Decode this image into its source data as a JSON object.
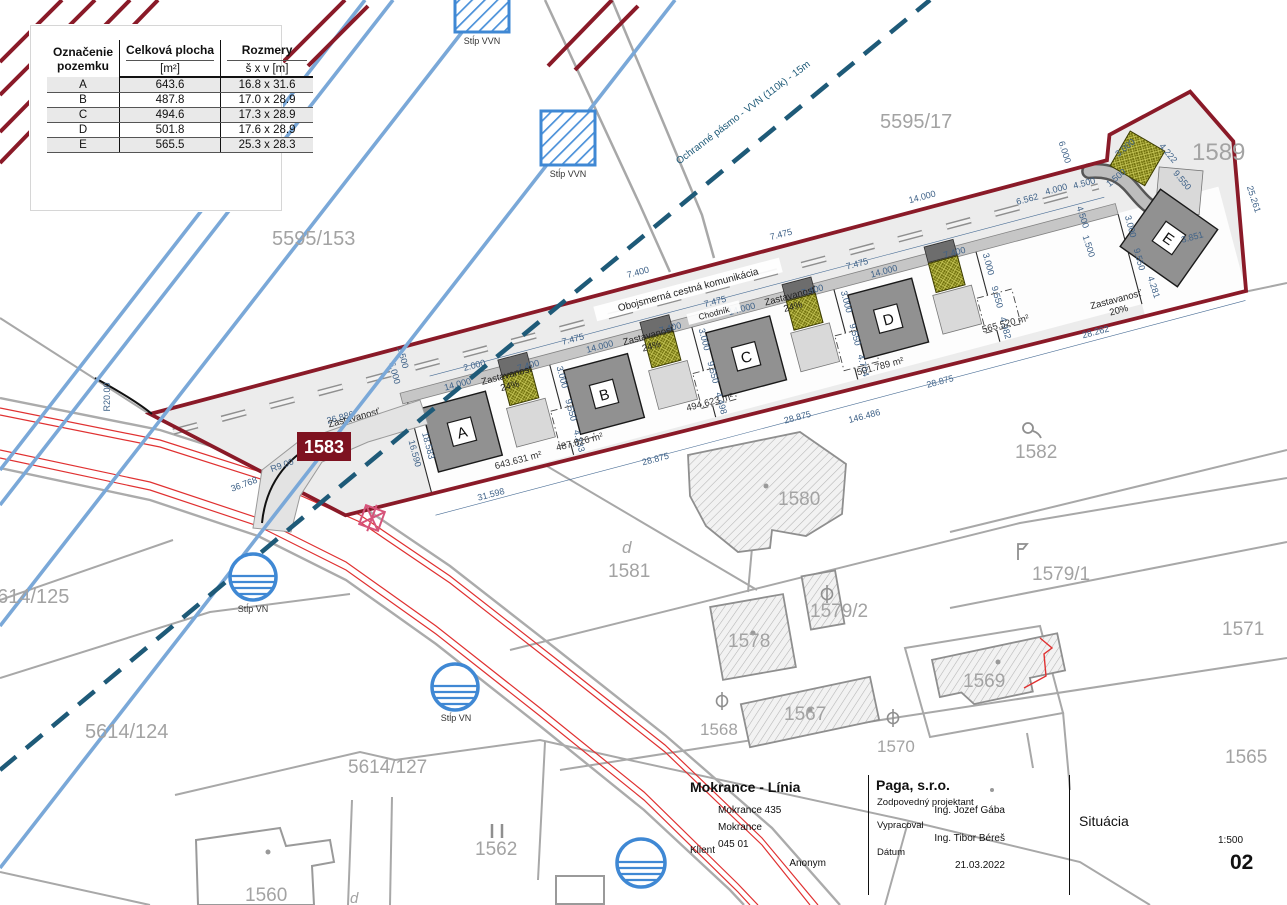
{
  "legend": {
    "col1_line1": "Označenie",
    "col1_line2": "pozemku",
    "col2_header": "Celková plocha",
    "col2_unit": "[m²]",
    "col3_header": "Rozmery",
    "col3_unit": "š x v [m]",
    "rows": [
      {
        "id": "A",
        "area": "643.6",
        "dim": "16.8 x 31.6"
      },
      {
        "id": "B",
        "area": "487.8",
        "dim": "17.0 x 28.9"
      },
      {
        "id": "C",
        "area": "494.6",
        "dim": "17.3 x 28.9"
      },
      {
        "id": "D",
        "area": "501.8",
        "dim": "17.6 x 28.9"
      },
      {
        "id": "E",
        "area": "565.5",
        "dim": "25.3 x 28.3"
      }
    ]
  },
  "title_block": {
    "project_title": "Mokrance - Línia",
    "address1": "Mokrance 435",
    "address2": "Mokrance",
    "address3": "045 01",
    "client_label": "Klient",
    "client_value": "Anonym",
    "company": "Paga, s.r.o.",
    "responsible_label": "Zodpovedný projektant",
    "responsible_value": "Ing. Jozef Gába",
    "author_label": "Vypracoval",
    "author_value": "Ing. Tibor Béreš",
    "date_label": "Dátum",
    "date_value": "21.03.2022",
    "drawing_title": "Situácia",
    "scale": "1:500",
    "sheet_number": "02"
  },
  "labels": {
    "road": "Obojsmerná cestná komunikácia",
    "sidewalk": "Chodník",
    "protection_zone": "Ochranné pásmo - VVN (110k) - 15m",
    "pole_vvn": "Stĺp VVN",
    "pole_vn": "Stĺp VN",
    "site_parcel": "1583"
  },
  "houses": {
    "a": "A",
    "b": "B",
    "c": "C",
    "d": "D",
    "e": "E"
  },
  "coverage": {
    "label": "Zastavanosť",
    "a": "18%",
    "b": "24%",
    "c": "24%",
    "d": "24%",
    "e": "20%"
  },
  "areas": {
    "a": "643.631 m²",
    "b": "487.826 m²",
    "c": "494.623 m²",
    "d": "501.789 m²",
    "e": "565.520 m²"
  },
  "dims": [
    "26.886",
    "6.000",
    "14.000",
    "7.400",
    "2.000",
    "7.475",
    "1.500",
    "3.000",
    "9.550",
    "4.233",
    "4.498",
    "4.704",
    "4.982",
    "18.583",
    "16.590",
    "31.598",
    "28.875",
    "146.486",
    "28.262",
    "25.261",
    "3.851",
    "4.281",
    "4.222",
    "6.562",
    "4.000",
    "4.500",
    "36.768",
    "R9.00",
    "R20.00"
  ],
  "parcels": {
    "p5595_17": "5595/17",
    "p5595_153": "5595/153",
    "p1589": "1589",
    "p1582": "1582",
    "p1580": "1580",
    "p1581": "1581",
    "p1579_2": "1579/2",
    "p1578": "1578",
    "p1579_1": "1579/1",
    "p1571": "1571",
    "p1568": "1568",
    "p1567": "1567",
    "p1570": "1570",
    "p1569": "1569",
    "p1565": "1565",
    "p5614_125": "5614/125",
    "p5614_124": "5614/124",
    "p5614_127": "5614/127",
    "p1562": "1562",
    "p1560": "1560",
    "d": "d"
  }
}
